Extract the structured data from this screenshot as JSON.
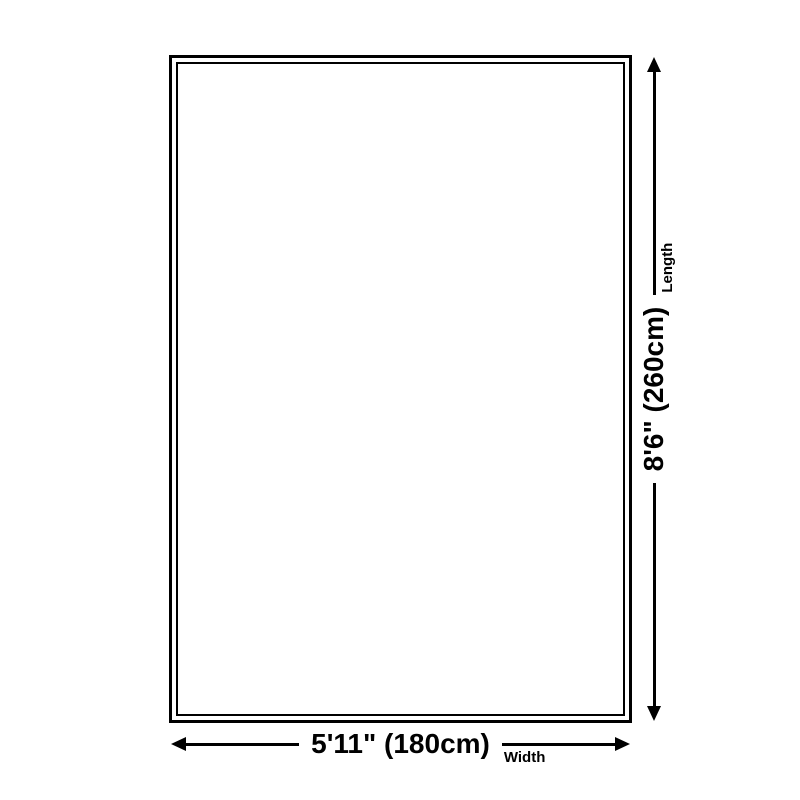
{
  "dimensions": {
    "length": {
      "value": "8'6\" (260cm)",
      "label": "Length"
    },
    "width": {
      "value": "5'11\" (180cm)",
      "label": "Width"
    }
  },
  "colors": {
    "line": "#000000",
    "background": "#ffffff"
  }
}
